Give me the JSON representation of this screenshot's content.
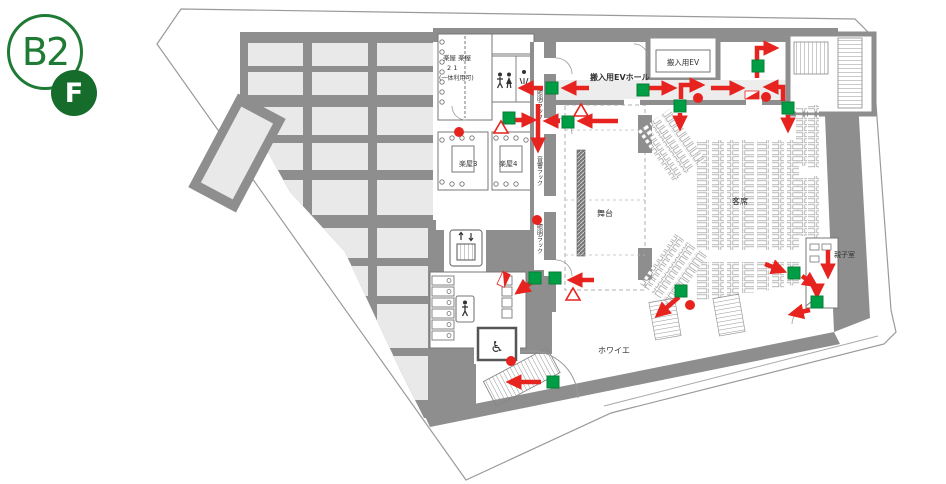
{
  "floor_badge": {
    "level": "B2",
    "floor_suffix": "F"
  },
  "map": {
    "labels": {
      "loading_ev_hall": "搬入用EVホール",
      "loading_ev": "搬入用EV",
      "stage": "舞台",
      "audience": "客席",
      "parent_child_room": "親子室",
      "foyer": "ホワイエ",
      "dressing_1_2_line1": "楽屋 楽屋",
      "dressing_1_2_line2": "2    1",
      "dressing_1_2_line3": "(一体利用可)",
      "dressing_3": "楽屋3",
      "dressing_4": "楽屋4",
      "racks": [
        "照明ラック",
        "音響ラック",
        "照明ラック"
      ]
    },
    "legend_colors": {
      "exit_green": "#009E44",
      "exit_green_border": "#0A7C38",
      "route_red": "#E6231E",
      "wall_gray": "#8E8E8E",
      "room_fill": "#E9E9E9",
      "badge_green": "#1E7A34"
    },
    "symbols": {
      "exit_lights": [
        [
          546,
          82
        ],
        [
          503,
          112
        ],
        [
          562,
          116
        ],
        [
          637,
          84
        ],
        [
          752,
          60
        ],
        [
          782,
          102
        ],
        [
          674,
          100
        ],
        [
          529,
          272
        ],
        [
          549,
          272
        ],
        [
          675,
          285
        ],
        [
          788,
          267
        ],
        [
          811,
          296
        ],
        [
          547,
          376
        ]
      ],
      "alarm_dots": [
        [
          459,
          132
        ],
        [
          537,
          220
        ],
        [
          698,
          98
        ],
        [
          766,
          97
        ],
        [
          690,
          305
        ],
        [
          511,
          361
        ]
      ],
      "triangles": [
        [
          501,
          127
        ],
        [
          581,
          110
        ],
        [
          573,
          294
        ]
      ],
      "hydrant_flags": [
        [
          745,
          91,
          0
        ],
        [
          497,
          284,
          -65
        ]
      ],
      "route_arrows": [
        [
          [
            589,
            88
          ],
          [
            565,
            88
          ]
        ],
        [
          [
            543,
            88
          ],
          [
            522,
            88
          ]
        ],
        [
          [
            506,
            120
          ],
          [
            533,
            120
          ]
        ],
        [
          [
            538,
            104
          ],
          [
            538,
            149
          ]
        ],
        [
          [
            560,
            121
          ],
          [
            547,
            121
          ]
        ],
        [
          [
            618,
            121
          ],
          [
            581,
            121
          ]
        ],
        [
          [
            647,
            88
          ],
          [
            673,
            88
          ]
        ],
        [
          [
            681,
            99
          ],
          [
            681,
            85
          ],
          [
            701,
            85
          ]
        ],
        [
          [
            711,
            88
          ],
          [
            741,
            88
          ]
        ],
        [
          [
            783,
            101
          ],
          [
            783,
            87
          ],
          [
            767,
            87
          ]
        ],
        [
          [
            757,
            78
          ],
          [
            757,
            48
          ],
          [
            775,
            48
          ]
        ],
        [
          [
            680,
            113
          ],
          [
            680,
            127
          ]
        ],
        [
          [
            788,
            115
          ],
          [
            788,
            129
          ]
        ],
        [
          [
            828,
            250
          ],
          [
            828,
            275
          ]
        ],
        [
          [
            765,
            264
          ],
          [
            783,
            271
          ]
        ],
        [
          [
            802,
            276
          ],
          [
            815,
            285
          ]
        ],
        [
          [
            817,
            285
          ],
          [
            817,
            295
          ]
        ],
        [
          [
            810,
            310
          ],
          [
            792,
            314
          ]
        ],
        [
          [
            679,
            297
          ],
          [
            658,
            315
          ]
        ],
        [
          [
            594,
            280
          ],
          [
            571,
            280
          ]
        ],
        [
          [
            532,
            282
          ],
          [
            518,
            292
          ]
        ],
        [
          [
            541,
            382
          ],
          [
            510,
            382
          ]
        ]
      ]
    }
  }
}
